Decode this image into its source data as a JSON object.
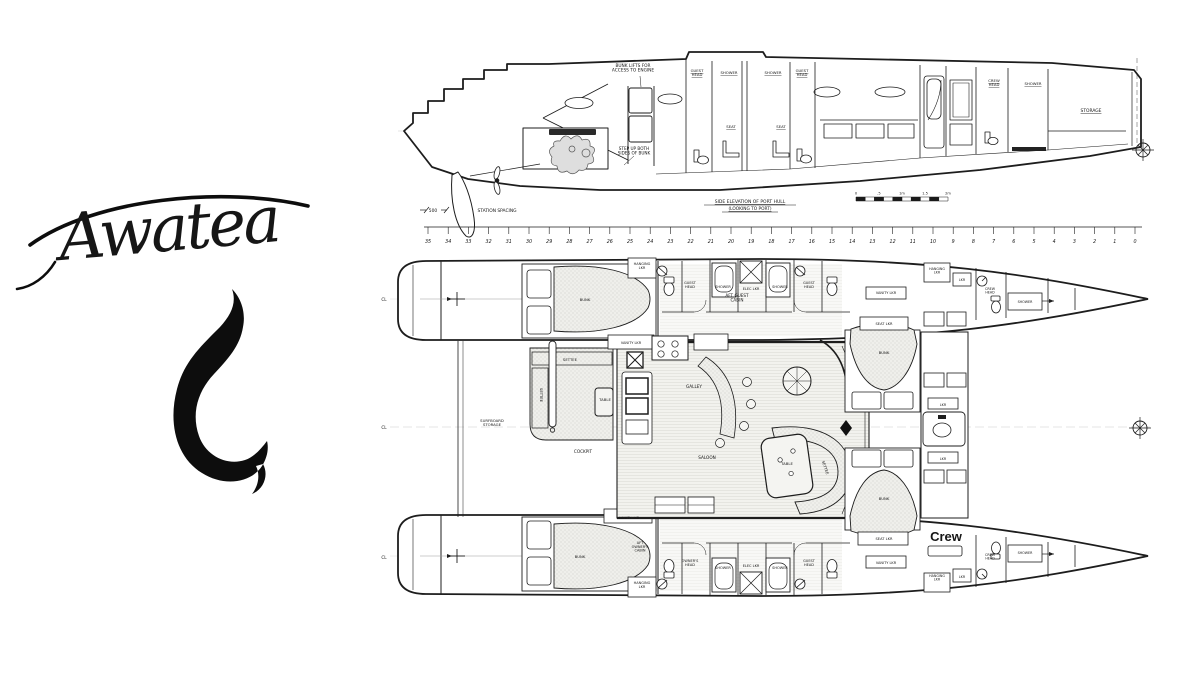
{
  "logo": {
    "name": "Awatea",
    "symbol": "maori-fish-hook-icon"
  },
  "colors": {
    "ink": "#1d1d1d",
    "paper": "#ffffff",
    "texture": "#bfbfba"
  },
  "elevation": {
    "labels": [
      {
        "t": "BUNK LIFTS FOR|ACCESS TO ENGINE",
        "x": 633,
        "y": 67,
        "s": 4.3,
        "n": "note-bunk-lifts"
      },
      {
        "t": "GUEST|HEAD",
        "x": 697,
        "y": 72,
        "s": 3.8,
        "u": 1
      },
      {
        "t": "SHOWER",
        "x": 729,
        "y": 74,
        "s": 3.8,
        "u": 1
      },
      {
        "t": "SHOWER",
        "x": 773,
        "y": 74,
        "s": 3.8,
        "u": 1
      },
      {
        "t": "GUEST|HEAD",
        "x": 802,
        "y": 72,
        "s": 3.8,
        "u": 1
      },
      {
        "t": "SEAT",
        "x": 731,
        "y": 128,
        "s": 3.8,
        "u": 1
      },
      {
        "t": "SEAT",
        "x": 781,
        "y": 128,
        "s": 3.8,
        "u": 1
      },
      {
        "t": "CREW|HEAD",
        "x": 994,
        "y": 82,
        "s": 3.8,
        "u": 1
      },
      {
        "t": "SHOWER",
        "x": 1033,
        "y": 85,
        "s": 3.8,
        "u": 1
      },
      {
        "t": "STORAGE",
        "x": 1091,
        "y": 112,
        "s": 4.4,
        "u": 1
      },
      {
        "t": "STEP UP BOTH|SIDES OF BUNK",
        "x": 634,
        "y": 150,
        "s": 4.2,
        "n": "note-step-up"
      },
      {
        "t": "500",
        "x": 433,
        "y": 212,
        "s": 4.4,
        "n": "station-spacing-dim"
      },
      {
        "t": "STATION  SPACING",
        "x": 497,
        "y": 212,
        "s": 4.4,
        "n": "station-spacing-label"
      },
      {
        "t": "SIDE ELEVATION OF PORT HULL",
        "x": 750,
        "y": 203,
        "s": 4.5,
        "u": 1,
        "n": "elevation-caption"
      },
      {
        "t": "(LOOKING TO PORT)",
        "x": 750,
        "y": 210,
        "s": 4.3,
        "u": 1,
        "n": "elevation-caption-2"
      }
    ],
    "scale_bar": {
      "labels": [
        "0",
        ".5",
        "1m",
        "1.5",
        "2m"
      ]
    }
  },
  "ruler": {
    "stations": [
      "35",
      "34",
      "33",
      "32",
      "31",
      "30",
      "29",
      "28",
      "27",
      "26",
      "25",
      "24",
      "23",
      "22",
      "21",
      "20",
      "19",
      "18",
      "17",
      "16",
      "15",
      "14",
      "13",
      "12",
      "11",
      "10",
      "9",
      "8",
      "7",
      "6",
      "5",
      "4",
      "3",
      "2",
      "1",
      "0"
    ]
  },
  "plan": {
    "labels": [
      {
        "t": "HANGING|LKR",
        "x": 642,
        "y": 265,
        "s": 3.5
      },
      {
        "t": "BUNK",
        "x": 585,
        "y": 301,
        "s": 3.8
      },
      {
        "t": "AFT GUEST|CABIN",
        "x": 737,
        "y": 297,
        "s": 4.2
      },
      {
        "t": "GUEST|HEAD",
        "x": 690,
        "y": 284,
        "s": 3.5
      },
      {
        "t": "SHOWER",
        "x": 723,
        "y": 288,
        "s": 3.5
      },
      {
        "t": "ELEC LKR",
        "x": 751,
        "y": 290,
        "s": 3.5
      },
      {
        "t": "SHOWER",
        "x": 780,
        "y": 288,
        "s": 3.5
      },
      {
        "t": "GUEST|HEAD",
        "x": 809,
        "y": 284,
        "s": 3.5
      },
      {
        "t": "VANITY LKR",
        "x": 886,
        "y": 294,
        "s": 3.5
      },
      {
        "t": "HANGING|LKR",
        "x": 937,
        "y": 270,
        "s": 3.3
      },
      {
        "t": "LKR",
        "x": 962,
        "y": 281,
        "s": 3.3
      },
      {
        "t": "CREW|HEAD",
        "x": 990,
        "y": 290,
        "s": 3.3
      },
      {
        "t": "SHOWER",
        "x": 1025,
        "y": 303,
        "s": 3.3
      },
      {
        "t": "SEAT LKR",
        "x": 884,
        "y": 325,
        "s": 3.6
      },
      {
        "t": "BUNK",
        "x": 884,
        "y": 354,
        "s": 3.8
      },
      {
        "t": "LKR",
        "x": 943,
        "y": 406,
        "s": 3.3
      },
      {
        "t": "LKR",
        "x": 943,
        "y": 460,
        "s": 3.3
      },
      {
        "t": "BUNK",
        "x": 884,
        "y": 500,
        "s": 3.8
      },
      {
        "t": "SEAT LKR",
        "x": 884,
        "y": 540,
        "s": 3.6
      },
      {
        "t": "Crew",
        "x": 946,
        "y": 541,
        "s": 13,
        "b": 1,
        "n": "crew-area-label"
      },
      {
        "t": "VANITY LKR",
        "x": 631,
        "y": 344,
        "s": 3.5
      },
      {
        "t": "GALLEY",
        "x": 694,
        "y": 388,
        "s": 4.2
      },
      {
        "t": "SALOON",
        "x": 707,
        "y": 459,
        "s": 4.2
      },
      {
        "t": "TABLE",
        "x": 787,
        "y": 465,
        "s": 3.8
      },
      {
        "t": "SETTEE",
        "x": 824,
        "y": 468,
        "s": 3.8,
        "rot": 72
      },
      {
        "t": "SETTEE",
        "x": 570,
        "y": 361,
        "s": 3.8
      },
      {
        "t": "SETTEE",
        "x": 540,
        "y": 395,
        "s": 3.8,
        "rot": 90
      },
      {
        "t": "TABLE",
        "x": 605,
        "y": 401,
        "s": 3.8
      },
      {
        "t": "COCKPIT",
        "x": 583,
        "y": 453,
        "s": 4.2
      },
      {
        "t": "VANITY LKR",
        "x": 629,
        "y": 519,
        "s": 3.5
      },
      {
        "t": "SURFBOARD|STORAGE",
        "x": 492,
        "y": 422,
        "s": 3.8
      },
      {
        "t": "VANITY LKR",
        "x": 886,
        "y": 564,
        "s": 3.5
      },
      {
        "t": "BUNK",
        "x": 580,
        "y": 558,
        "s": 3.8
      },
      {
        "t": "AFT|OWNER'S|CABIN",
        "x": 640,
        "y": 544,
        "s": 3.5
      },
      {
        "t": "OWNER'S|HEAD",
        "x": 690,
        "y": 562,
        "s": 3.5
      },
      {
        "t": "SHOWER",
        "x": 723,
        "y": 569,
        "s": 3.5
      },
      {
        "t": "ELEC LKR",
        "x": 751,
        "y": 567,
        "s": 3.5
      },
      {
        "t": "SHOWER",
        "x": 780,
        "y": 569,
        "s": 3.5
      },
      {
        "t": "GUEST|HEAD",
        "x": 809,
        "y": 562,
        "s": 3.5
      },
      {
        "t": "HANGING|LKR",
        "x": 937,
        "y": 577,
        "s": 3.3
      },
      {
        "t": "LKR",
        "x": 962,
        "y": 578,
        "s": 3.3
      },
      {
        "t": "CREW|HEAD",
        "x": 990,
        "y": 556,
        "s": 3.3
      },
      {
        "t": "SHOWER",
        "x": 1025,
        "y": 554,
        "s": 3.3
      },
      {
        "t": "HANGING|LKR",
        "x": 642,
        "y": 584,
        "s": 3.5
      },
      {
        "t": "CL",
        "x": 384,
        "y": 301,
        "s": 4.2,
        "n": "centerline-port"
      },
      {
        "t": "CL",
        "x": 384,
        "y": 429,
        "s": 4.2,
        "n": "centerline-vessel"
      },
      {
        "t": "CL",
        "x": 384,
        "y": 559,
        "s": 4.2,
        "n": "centerline-starboard"
      }
    ]
  }
}
